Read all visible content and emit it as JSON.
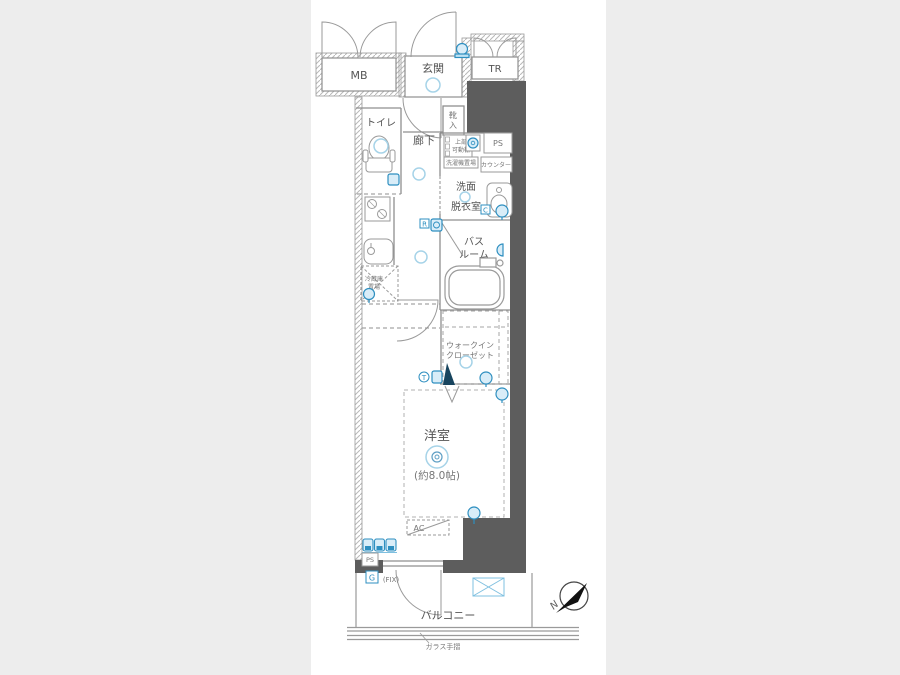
{
  "plan": {
    "meter_box": "MB",
    "entrance": "玄関",
    "trunk_room": "TR",
    "toilet": "トイレ",
    "hallway": "廊下",
    "shoe_box_l1": "靴",
    "shoe_box_l2": "入",
    "upper_shelf_l1": "上部",
    "upper_shelf_l2": "可動棚",
    "washer_place": "洗濯機置場",
    "ps_top": "PS",
    "counter": "カウンター",
    "washroom_l1": "洗面",
    "washroom_l2": "脱衣室",
    "bathroom_l1": "バス",
    "bathroom_l2": "ルーム",
    "fridge_l1": "冷蔵庫",
    "fridge_l2": "置場",
    "wic_l1": "ウォークイン",
    "wic_l2": "クローゼット",
    "main_room": "洋室",
    "main_room_size": "(約8.0帖)",
    "ac": "AC",
    "ps_bottom": "PS",
    "fix": "(FIX)",
    "balcony": "バルコニー",
    "glass_rail": "ガラス手摺",
    "compass_north": "N",
    "badge_r": "R",
    "badge_c": "C",
    "badge_g": "G",
    "badge_t": "T"
  },
  "icons": [
    "ceiling-light",
    "intercom",
    "washing-machine",
    "toilet-fixture",
    "bathtub",
    "washbasin",
    "kitchen-stove",
    "kitchen-sink",
    "fridge-mark",
    "water-heater",
    "compass-north-arrow"
  ],
  "colors": {
    "background": "#ededed",
    "paper": "#ffffff",
    "wall_dark": "#5d5d5d",
    "line_gray": "#8f8f8f",
    "accent_blue": "#2e8fc0",
    "light_blue": "#a6d3e8",
    "icon_fill": "#d9edf8"
  }
}
